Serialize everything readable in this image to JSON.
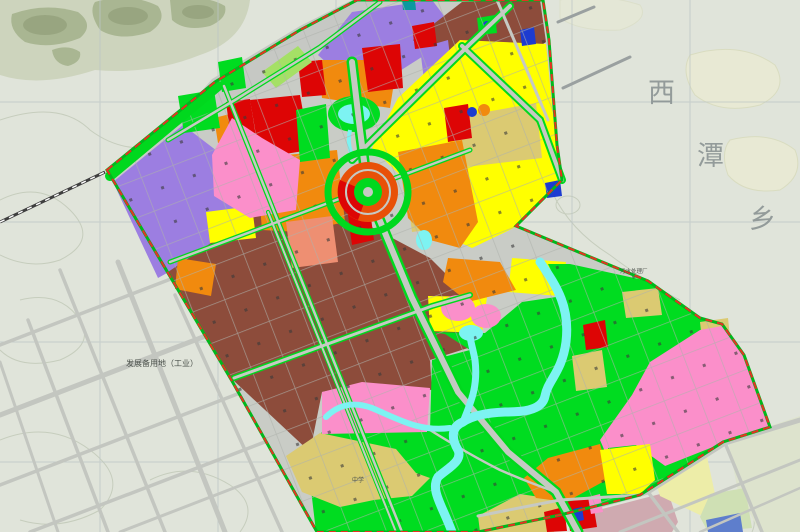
{
  "map": {
    "title": "urban land-use planning map",
    "region_label": {
      "text": "西潭乡",
      "chars": [
        "西",
        "潭",
        "乡"
      ]
    },
    "annotations": {
      "reserve_area": "发展备用地（工业）",
      "treatment_plant": "污水处理厂",
      "school": "中学"
    }
  },
  "palette": {
    "bg": "#e0e4da",
    "hillLight": "#cdd4bd",
    "hillMid": "#a9b692",
    "hillDark": "#96a37e",
    "contour": "#c6cdbd",
    "tanBlob": "#e8e9d4",
    "tanBlobEdge": "#d9dcc0",
    "grid": "#bcc6c6",
    "outsideRoad": "#c3c6c0",
    "railway": "#3f3f3f",
    "planBase": "#c9ccc6",
    "road": "#c6c9c3",
    "strip": "#c6c8c4",
    "purple": "#9c7ee1",
    "brown": "#8d4c3b",
    "yellow": "#ffff00",
    "khaki": "#dbca72",
    "orange": "#f18a0e",
    "vermilion": "#e85008",
    "red": "#dd0505",
    "pink": "#fb8fca",
    "salmon": "#ee8f72",
    "green": "#00dc20",
    "greenRoad": "#00d81e",
    "lightGreen": "#a5e066",
    "cyan": "#7df3f2",
    "blue": "#1d3bd0",
    "teal": "#0d98a0",
    "mauve": "#cfaab0",
    "paleYellow": "#ededa8",
    "paleGreen": "#cfe0b4",
    "paleSage": "#dde3cd",
    "blueOutside": "#5e7ecc",
    "boundaryRed": "#e63022",
    "boundaryGreen": "#00b81c",
    "parcelLine": "#aeb2ac",
    "dot": "#3a3a3a",
    "labelGray": "#8b9494",
    "labelDark": "#4c524c"
  }
}
